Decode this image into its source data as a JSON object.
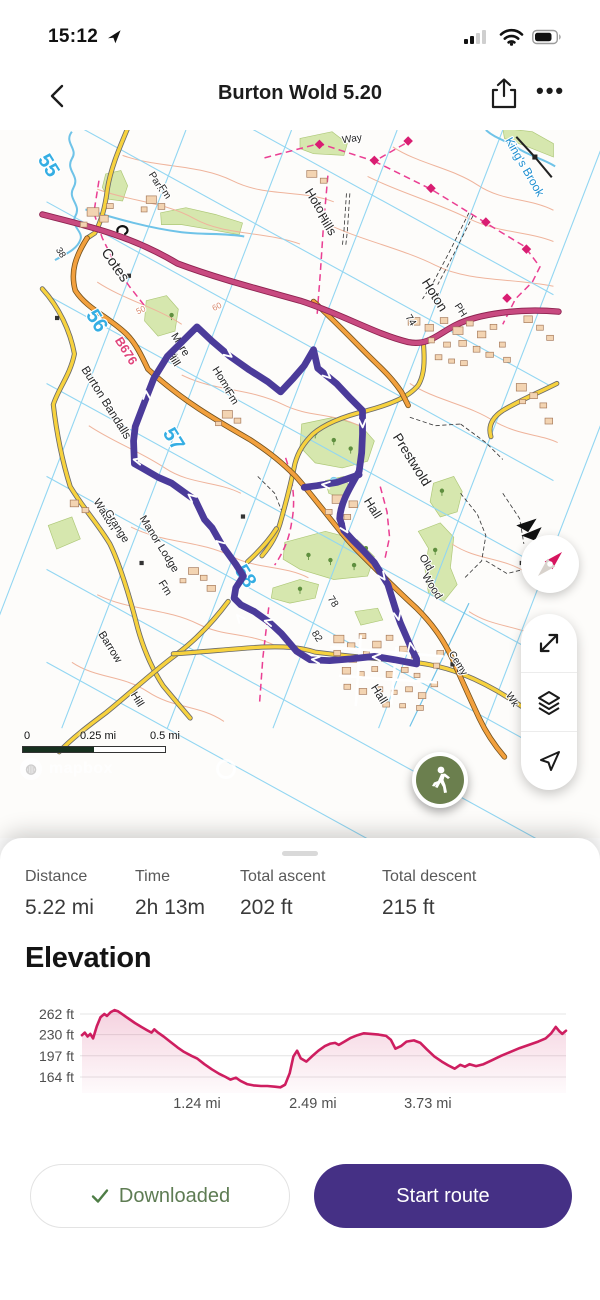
{
  "status_bar": {
    "time": "15:12"
  },
  "nav": {
    "title": "Burton Wold 5.20"
  },
  "map": {
    "scale": [
      "0",
      "0.25 mi",
      "0.5 mi"
    ],
    "attribution": "mapbox",
    "colors": {
      "route": "#4b3b9a",
      "marker": "#6b7f4e"
    },
    "labels": [
      {
        "t": "55",
        "x": -4,
        "y": 176,
        "r": 58,
        "c": "grid",
        "s": 24
      },
      {
        "t": "56",
        "x": 53,
        "y": 360,
        "r": 58,
        "c": "grid",
        "s": 24
      },
      {
        "t": "57",
        "x": 144,
        "y": 500,
        "r": 58,
        "c": "grid",
        "s": 24
      },
      {
        "t": "58",
        "x": 229,
        "y": 662,
        "r": 58,
        "c": "grid",
        "s": 24
      },
      {
        "t": "B676",
        "x": 90,
        "y": 394,
        "r": 58,
        "c": "road",
        "s": 15
      },
      {
        "t": "38",
        "x": 14,
        "y": 277,
        "r": 58,
        "c": "place",
        "s": 11
      },
      {
        "t": "74",
        "x": 428,
        "y": 357,
        "r": 58,
        "c": "place",
        "s": 12
      },
      {
        "t": "78",
        "x": 336,
        "y": 690,
        "r": 58,
        "c": "place",
        "s": 12
      },
      {
        "t": "82",
        "x": 317,
        "y": 731,
        "r": 58,
        "c": "place",
        "s": 12
      },
      {
        "t": "Park",
        "x": 127,
        "y": 193,
        "r": 58,
        "c": "place",
        "s": 12
      },
      {
        "t": "Fm",
        "x": 137,
        "y": 205,
        "r": 58,
        "c": "place",
        "s": 12
      },
      {
        "t": "Cotes",
        "x": 77,
        "y": 293,
        "r": 55,
        "c": "place",
        "s": 17
      },
      {
        "t": "Hoton",
        "x": 316,
        "y": 220,
        "r": 58,
        "c": "place",
        "s": 15
      },
      {
        "t": "Hills",
        "x": 328,
        "y": 244,
        "r": 58,
        "c": "place",
        "s": 15
      },
      {
        "t": "Way",
        "x": 362,
        "y": 144,
        "r": -8,
        "c": "place",
        "s": 12
      },
      {
        "t": "King's Brook",
        "x": 562,
        "y": 176,
        "r": 60,
        "c": "water",
        "s": 14
      },
      {
        "t": "Hoton",
        "x": 455,
        "y": 328,
        "r": 58,
        "c": "place",
        "s": 16
      },
      {
        "t": "PH",
        "x": 487,
        "y": 345,
        "r": 58,
        "c": "place",
        "s": 12
      },
      {
        "t": "Mere",
        "x": 155,
        "y": 386,
        "r": 58,
        "c": "place",
        "s": 13
      },
      {
        "t": "Hill",
        "x": 147,
        "y": 403,
        "r": 58,
        "c": "place",
        "s": 13
      },
      {
        "t": "Home",
        "x": 205,
        "y": 428,
        "r": 58,
        "c": "place",
        "s": 13
      },
      {
        "t": "Fm",
        "x": 216,
        "y": 448,
        "r": 58,
        "c": "place",
        "s": 13
      },
      {
        "t": "Burton Bandalls",
        "x": 67,
        "y": 455,
        "r": 58,
        "c": "place",
        "s": 14
      },
      {
        "t": "Watton",
        "x": 66,
        "y": 587,
        "r": 58,
        "c": "place",
        "s": 13
      },
      {
        "t": "Grange",
        "x": 80,
        "y": 601,
        "r": 58,
        "c": "place",
        "s": 13
      },
      {
        "t": "Manor Lodge",
        "x": 130,
        "y": 622,
        "r": 58,
        "c": "place",
        "s": 13
      },
      {
        "t": "Fm",
        "x": 137,
        "y": 674,
        "r": 58,
        "c": "place",
        "s": 13
      },
      {
        "t": "Prestwold",
        "x": 428,
        "y": 523,
        "r": 58,
        "c": "place",
        "s": 16
      },
      {
        "t": "Hall",
        "x": 382,
        "y": 580,
        "r": 58,
        "c": "place",
        "s": 15
      },
      {
        "t": "Old",
        "x": 446,
        "y": 644,
        "r": 58,
        "c": "place",
        "s": 13
      },
      {
        "t": "Wood",
        "x": 453,
        "y": 672,
        "r": 58,
        "c": "place",
        "s": 13
      },
      {
        "t": "Tw",
        "x": 589,
        "y": 654,
        "r": 58,
        "c": "place",
        "s": 12
      },
      {
        "t": "Cemy",
        "x": 484,
        "y": 763,
        "r": 58,
        "c": "place",
        "s": 12
      },
      {
        "t": "Wk",
        "x": 548,
        "y": 806,
        "r": 58,
        "c": "place",
        "s": 12
      },
      {
        "t": "Hall",
        "x": 390,
        "y": 800,
        "r": 58,
        "c": "place",
        "s": 14
      },
      {
        "t": "Barrow",
        "x": 72,
        "y": 744,
        "r": 58,
        "c": "place",
        "s": 13
      },
      {
        "t": "Hill",
        "x": 104,
        "y": 806,
        "r": 58,
        "c": "place",
        "s": 13
      },
      {
        "t": "50",
        "x": 113,
        "y": 346,
        "r": -25,
        "c": "contour",
        "s": 10
      },
      {
        "t": "60",
        "x": 203,
        "y": 342,
        "r": -25,
        "c": "contour",
        "s": 10
      }
    ]
  },
  "stats": {
    "items": [
      {
        "label": "Distance",
        "value": "5.22 mi"
      },
      {
        "label": "Time",
        "value": "2h 13m"
      },
      {
        "label": "Total ascent",
        "value": "202 ft"
      },
      {
        "label": "Total descent",
        "value": "215 ft"
      }
    ]
  },
  "elevation": {
    "title": "Elevation"
  },
  "chart_data": {
    "type": "area",
    "title": "Elevation",
    "x_unit": "mi",
    "y_unit": "ft",
    "total_distance_mi": 5.22,
    "line_color": "#ce1e60",
    "grid": true,
    "y_ticks": [
      {
        "ft": 262,
        "label": "262 ft"
      },
      {
        "ft": 230,
        "label": "230 ft"
      },
      {
        "ft": 197,
        "label": "197 ft"
      },
      {
        "ft": 164,
        "label": "164 ft"
      }
    ],
    "x_ticks": [
      {
        "d": 1.24,
        "label": "1.24 mi"
      },
      {
        "d": 2.49,
        "label": "2.49 mi"
      },
      {
        "d": 3.73,
        "label": "3.73 mi"
      }
    ],
    "profile": [
      [
        0,
        229
      ],
      [
        0.03,
        233
      ],
      [
        0.06,
        227
      ],
      [
        0.09,
        231
      ],
      [
        0.12,
        224
      ],
      [
        0.16,
        243
      ],
      [
        0.2,
        257
      ],
      [
        0.24,
        262
      ],
      [
        0.27,
        259
      ],
      [
        0.31,
        265
      ],
      [
        0.35,
        268
      ],
      [
        0.39,
        266
      ],
      [
        0.44,
        261
      ],
      [
        0.5,
        255
      ],
      [
        0.57,
        248
      ],
      [
        0.64,
        242
      ],
      [
        0.7,
        237
      ],
      [
        0.75,
        233
      ],
      [
        0.78,
        238
      ],
      [
        0.82,
        233
      ],
      [
        0.88,
        227
      ],
      [
        0.95,
        219
      ],
      [
        1.03,
        210
      ],
      [
        1.1,
        203
      ],
      [
        1.18,
        197
      ],
      [
        1.24,
        193
      ],
      [
        1.32,
        184
      ],
      [
        1.4,
        176
      ],
      [
        1.48,
        169
      ],
      [
        1.55,
        164
      ],
      [
        1.6,
        160
      ],
      [
        1.66,
        163
      ],
      [
        1.71,
        158
      ],
      [
        1.78,
        153
      ],
      [
        1.85,
        151
      ],
      [
        1.93,
        150
      ],
      [
        2.0,
        150
      ],
      [
        2.08,
        149
      ],
      [
        2.14,
        148
      ],
      [
        2.19,
        152
      ],
      [
        2.24,
        170
      ],
      [
        2.28,
        196
      ],
      [
        2.32,
        205
      ],
      [
        2.36,
        193
      ],
      [
        2.42,
        188
      ],
      [
        2.48,
        196
      ],
      [
        2.55,
        205
      ],
      [
        2.62,
        212
      ],
      [
        2.68,
        216
      ],
      [
        2.73,
        217
      ],
      [
        2.77,
        214
      ],
      [
        2.83,
        219
      ],
      [
        2.9,
        225
      ],
      [
        2.97,
        229
      ],
      [
        3.04,
        232
      ],
      [
        3.12,
        231
      ],
      [
        3.2,
        230
      ],
      [
        3.28,
        228
      ],
      [
        3.33,
        222
      ],
      [
        3.38,
        208
      ],
      [
        3.44,
        212
      ],
      [
        3.5,
        219
      ],
      [
        3.58,
        221
      ],
      [
        3.65,
        217
      ],
      [
        3.72,
        207
      ],
      [
        3.8,
        196
      ],
      [
        3.88,
        188
      ],
      [
        3.95,
        182
      ],
      [
        4.02,
        177
      ],
      [
        4.08,
        183
      ],
      [
        4.13,
        180
      ],
      [
        4.18,
        184
      ],
      [
        4.25,
        181
      ],
      [
        4.33,
        184
      ],
      [
        4.42,
        190
      ],
      [
        4.52,
        197
      ],
      [
        4.62,
        203
      ],
      [
        4.72,
        209
      ],
      [
        4.82,
        214
      ],
      [
        4.92,
        219
      ],
      [
        5.0,
        224
      ],
      [
        5.06,
        232
      ],
      [
        5.11,
        242
      ],
      [
        5.15,
        235
      ],
      [
        5.18,
        231
      ],
      [
        5.22,
        236
      ]
    ]
  },
  "buttons": {
    "downloaded": "Downloaded",
    "start": "Start route"
  }
}
